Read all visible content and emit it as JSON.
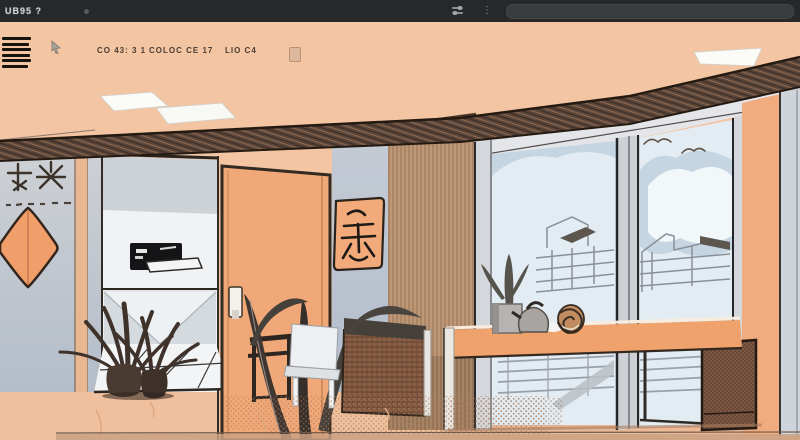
{
  "titlebar": {
    "logo_text": "UB95 ?",
    "bg_color": "#26282a",
    "status_icon": "status-dot",
    "icons": [
      "sliders-icon",
      "kebab-menu-icon"
    ],
    "field_value": ""
  },
  "toolbar": {
    "menu_icon": "hamburger-menu-icon",
    "pointer_icon": "cursor-icon",
    "items": [
      {
        "label": "CO 43: 3 1"
      },
      {
        "label": "COLOC CE 17"
      },
      {
        "label": "LIO C4"
      }
    ],
    "swatch_button": "color-swatch-button"
  },
  "canvas": {
    "colors": {
      "peach_wall": "#f3c5a2",
      "floor": "#f0c09e",
      "beam_brown": "#5a453a",
      "wall_blue_grey": "#bfc8d3",
      "door_orange": "#f1a878",
      "diamond_orange": "#f09f6b",
      "artwork_frame": "#f2aa7a",
      "curtain_tan": "#c69f7d",
      "sky_blue": "#e2ecf2",
      "cloud_grey_blue": "#c5d6e2",
      "wood_texture": "#7c5743",
      "tv_black": "#151517"
    }
  }
}
